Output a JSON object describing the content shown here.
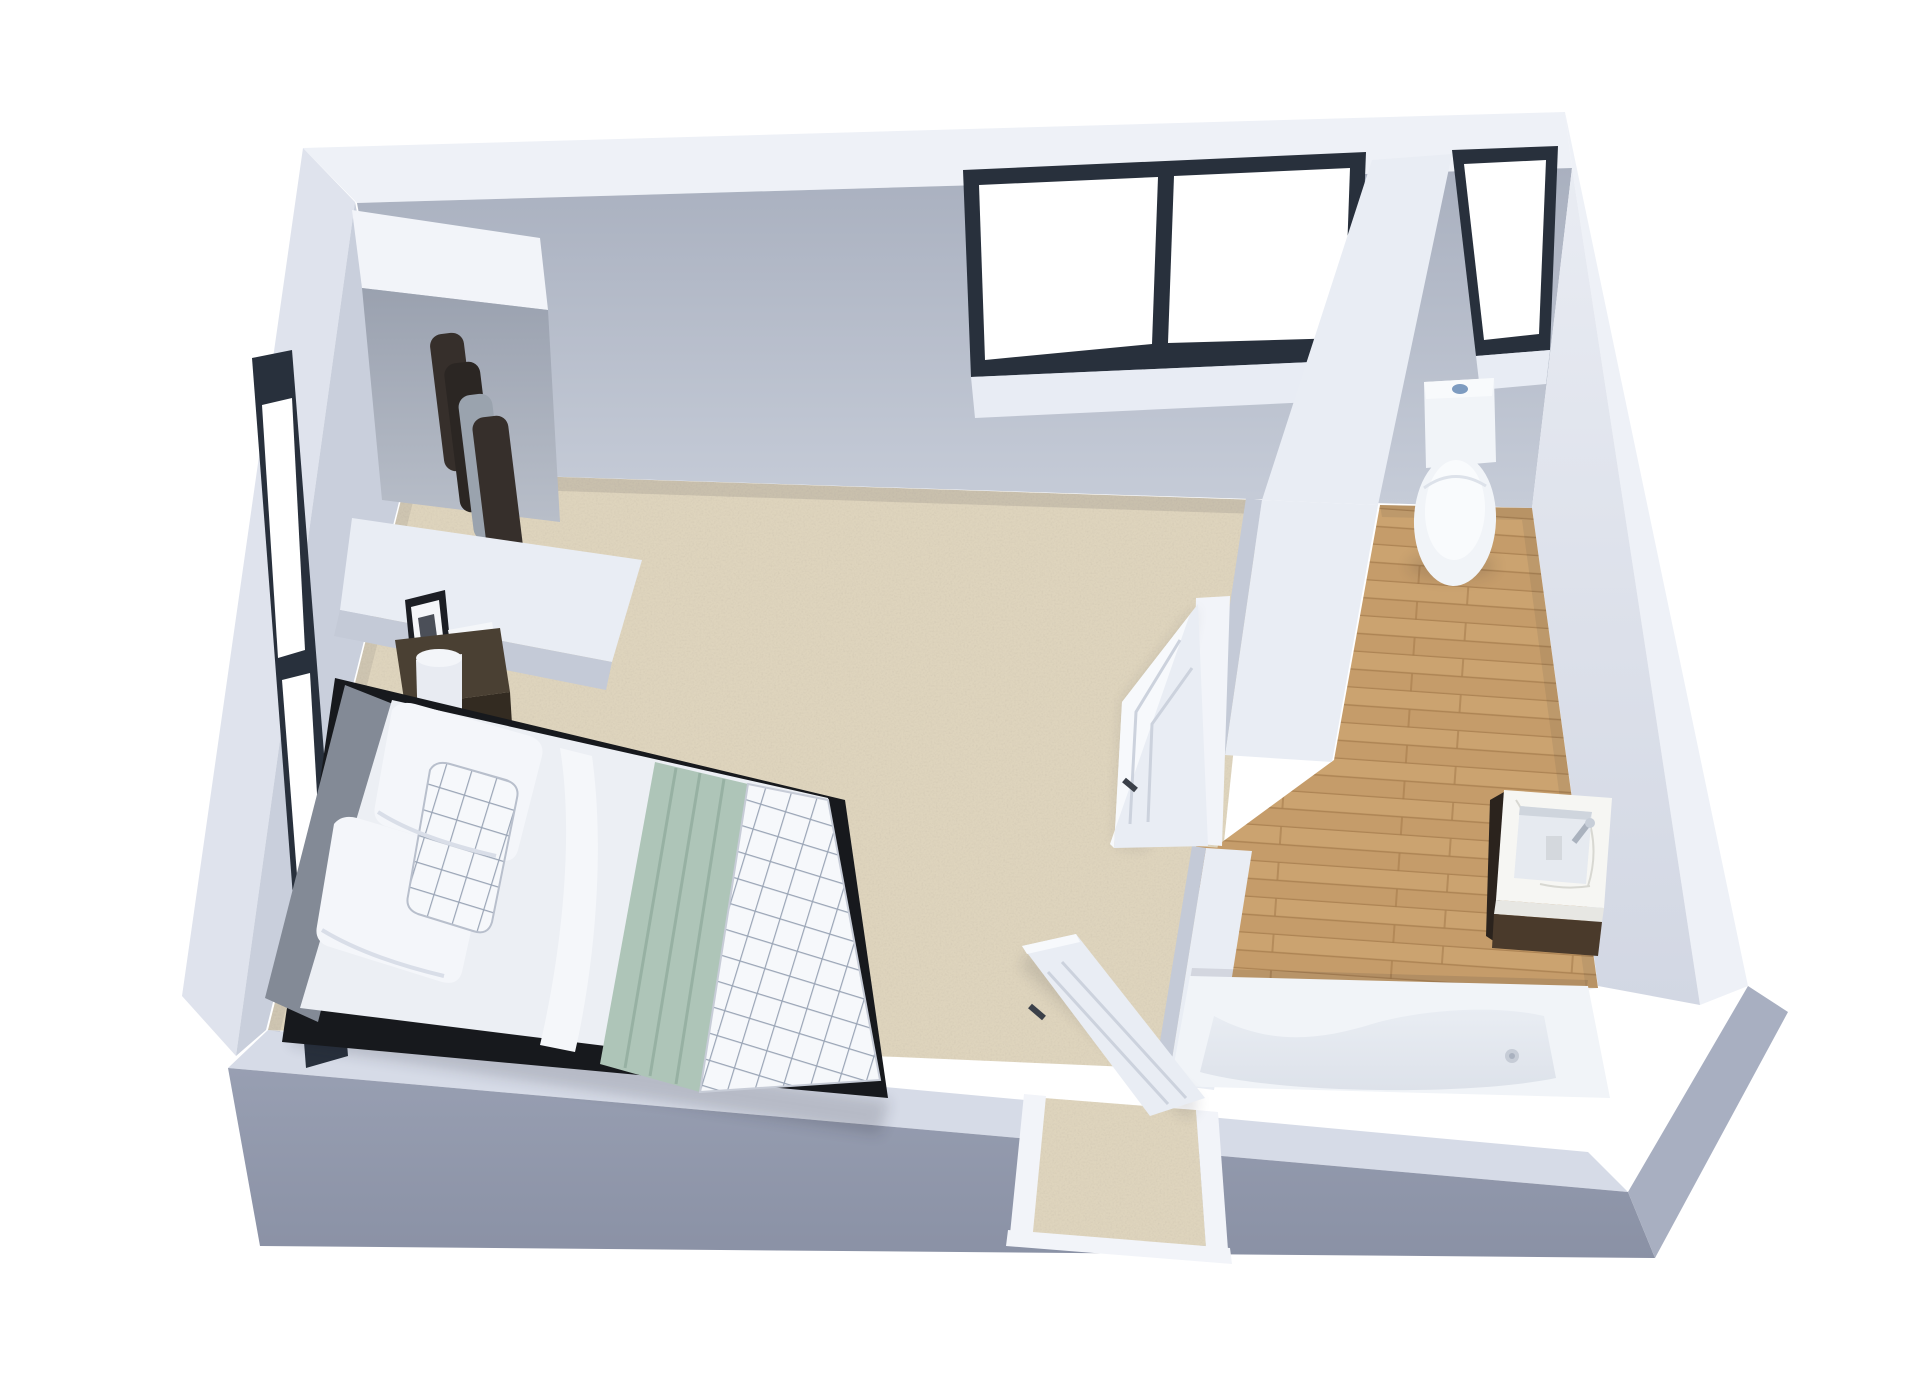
{
  "scene": {
    "view": "3d-dollhouse-floor-plan",
    "rooms": [
      {
        "name": "bedroom",
        "floor": "beige carpet",
        "contents": [
          "double bed with white duvet, sage green runner and checked throw",
          "grey upholstered headboard on black platform frame",
          "dark wood nightstand with cylinder lamp, photo frame and book",
          "open closet nook with hanging clothes",
          "tall side window on left wall",
          "wide two-pane window on top wall",
          "open entry door in bottom wall"
        ]
      },
      {
        "name": "bathroom",
        "floor": "light oak plank",
        "contents": [
          "toilet with blue flush button",
          "vanity with marble top, basin, chrome tap and dark wood cabinet",
          "built-in bathtub",
          "tall window on top wall",
          "open connecting door in partition wall"
        ]
      }
    ]
  },
  "palette": {
    "background": "#ffffff",
    "wall_top": "#eef1f7",
    "wall_inner_top_a": "#a9b0bf",
    "wall_inner_top_b": "#c6ccd8",
    "wall_inner_right_a": "#e9ecf3",
    "wall_inner_right_b": "#d2d7e3",
    "wall_inner_left": "#c9cfdc",
    "wall_outer_left": "#dfe3ed",
    "wall_band_bottom": "#d6dbe7",
    "wall_front_bottom_a": "#989fb2",
    "wall_front_bottom_b": "#8a91a5",
    "wall_outer_right": "#a8afc1",
    "wall_side_grey": "#c4cad7",
    "window_frame": "#28303c",
    "window_pane": "#ffffff",
    "window_sill": "#e8ecf4",
    "carpet_base": "#ded4bd",
    "carpet_speckle": "#8c7e63",
    "wood_base": "#c59c6a",
    "wood_light": "#d2ab78",
    "wood_seam": "#a67c4c",
    "door_face": "#e9edf4",
    "door_face_light": "#f6f8fb",
    "door_handle": "#3b4049",
    "frame_white": "#f2f4f9",
    "bed_frame_black": "#17191d",
    "headboard": "#838a96",
    "headboard_dark": "#6e7583",
    "duvet": "#eceff4",
    "pillow": "#f4f6fa",
    "pillow_shade": "#d9dee8",
    "grid_line": "#9aa5b6",
    "blanket_green": "#aec5b8",
    "blanket_green_dark": "#97b1a3",
    "nightstand_top": "#4a4033",
    "nightstand_front": "#332b21",
    "lamp": "#e8ebf2",
    "clothes_dark": "#362f2b",
    "clothes_darker": "#2b2623",
    "clothes_grey": "#9aa3ae",
    "fixture_white": "#f1f4f8",
    "fixture_shadow": "#dde2ea",
    "basin_inner": "#e6eaf0",
    "marble": "#f6f6f3",
    "marble_vein": "#d8d8d2",
    "cabinet_wood": "#4a3a2b",
    "cabinet_side": "#2b231d",
    "flush_button": "#7d9bc0",
    "chrome": "#aab2be"
  }
}
